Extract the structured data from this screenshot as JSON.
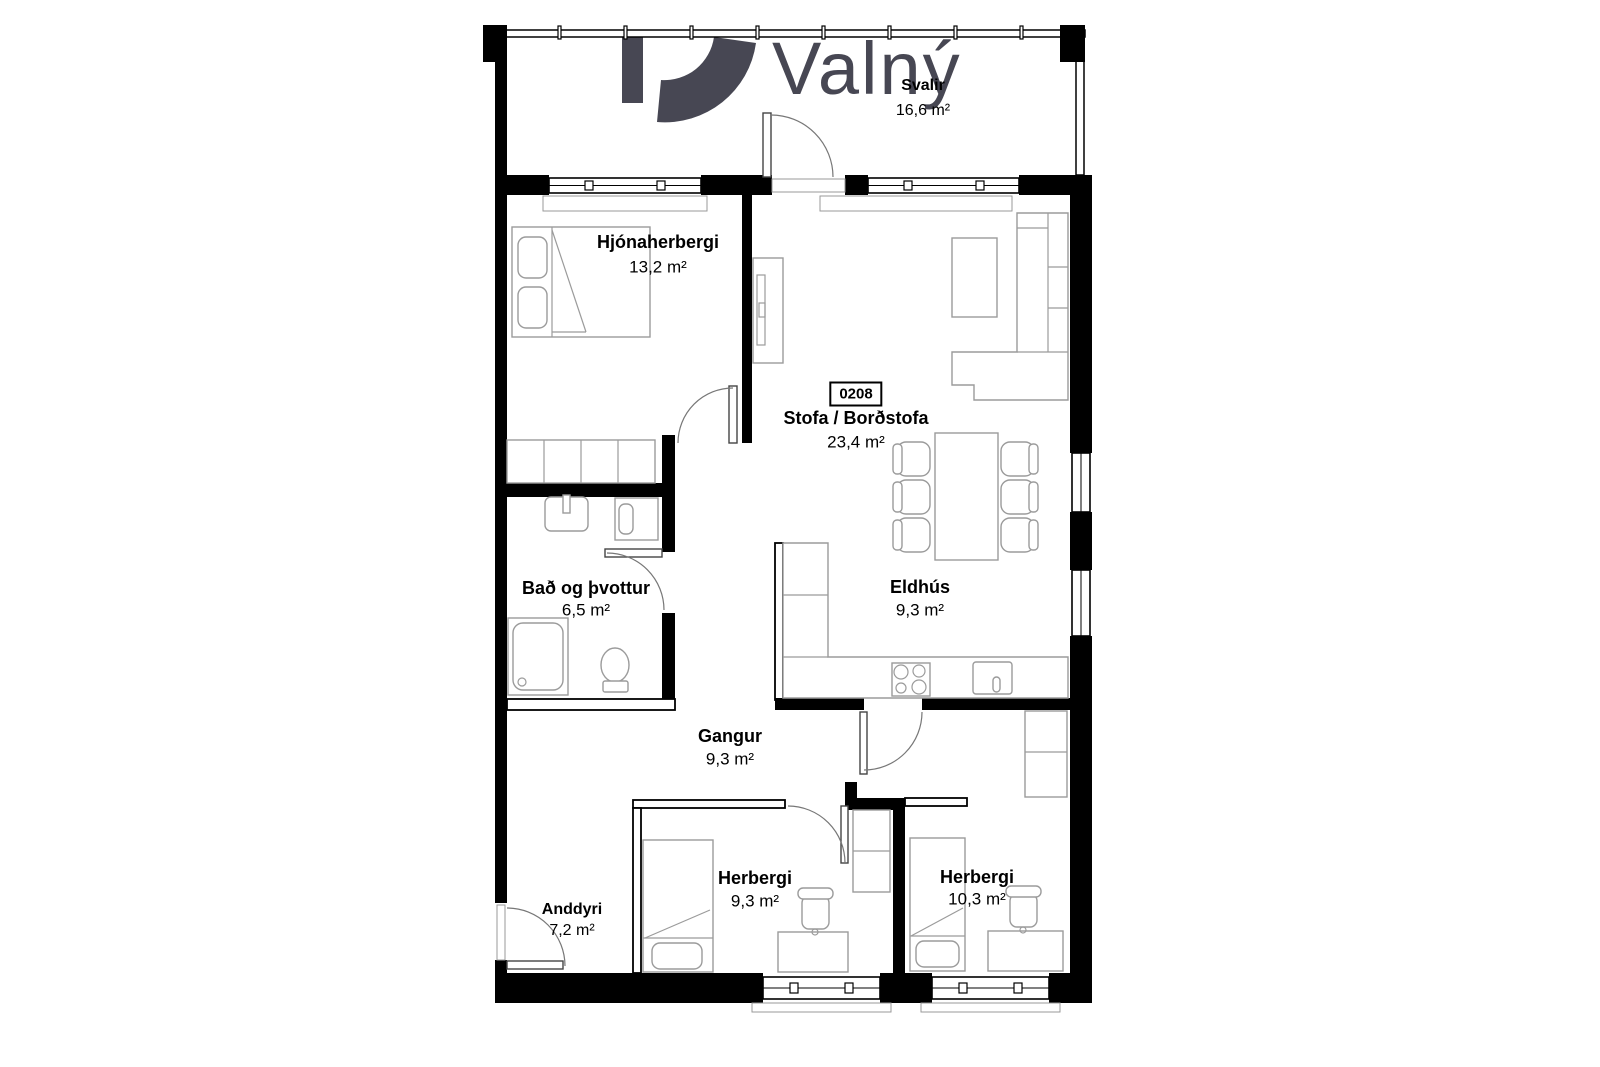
{
  "logo": {
    "brand": "Valný"
  },
  "unit_number": "0208",
  "rooms": [
    {
      "id": "svalir",
      "name": "Svalir",
      "area": "16,6 m²"
    },
    {
      "id": "hjonaherbergi",
      "name": "Hjónaherbergi",
      "area": "13,2 m²"
    },
    {
      "id": "stofa",
      "name": "Stofa / Borðstofa",
      "area": "23,4 m²"
    },
    {
      "id": "bad",
      "name": "Bað og þvottur",
      "area": "6,5 m²"
    },
    {
      "id": "eldhus",
      "name": "Eldhús",
      "area": "9,3 m²"
    },
    {
      "id": "gangur",
      "name": "Gangur",
      "area": "9,3 m²"
    },
    {
      "id": "anddyri",
      "name": "Anddyri",
      "area": "7,2 m²"
    },
    {
      "id": "herbergi-1",
      "name": "Herbergi",
      "area": "9,3 m²"
    },
    {
      "id": "herbergi-2",
      "name": "Herbergi",
      "area": "10,3 m²"
    }
  ],
  "colors": {
    "wall": "#000000",
    "furniture_line": "#9b9b9b",
    "logo": "#474753",
    "background": "#ffffff"
  }
}
